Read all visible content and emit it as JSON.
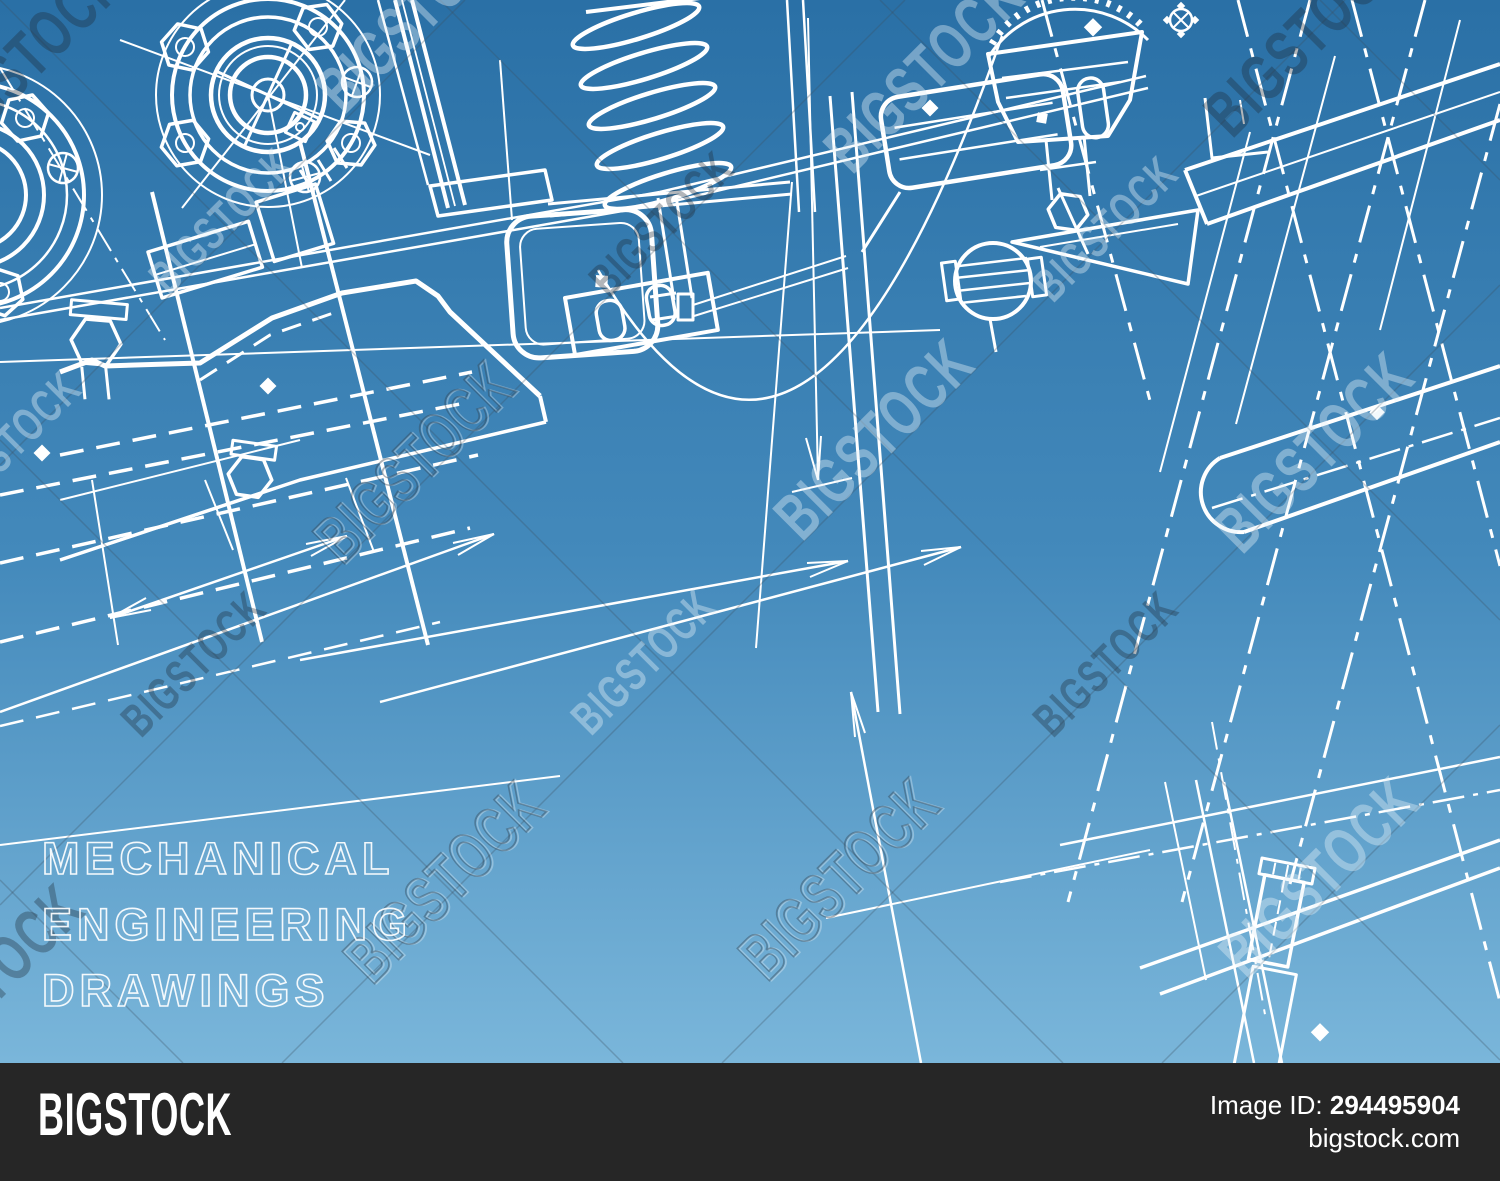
{
  "page": {
    "width": 1500,
    "height": 1181,
    "kind": "stock-photo watermark preview of a blueprint-style mechanical engineering drawing"
  },
  "colors": {
    "bg_top": "#2a70a6",
    "bg_mid": "#4389bb",
    "bg_bottom": "#7ab6da",
    "line": "#ffffff",
    "bar_bg": "#262626",
    "bar_text": "#ffffff"
  },
  "headline": {
    "line1": "MECHANICAL",
    "line2": "ENGINEERING",
    "line3": "DRAWINGS"
  },
  "watermark": {
    "brand": "BIGSTOCK"
  },
  "footer": {
    "logo": "BIGSTOCK",
    "image_id_label": "Image ID:",
    "image_id": "294495904",
    "site": "bigstock.com"
  }
}
